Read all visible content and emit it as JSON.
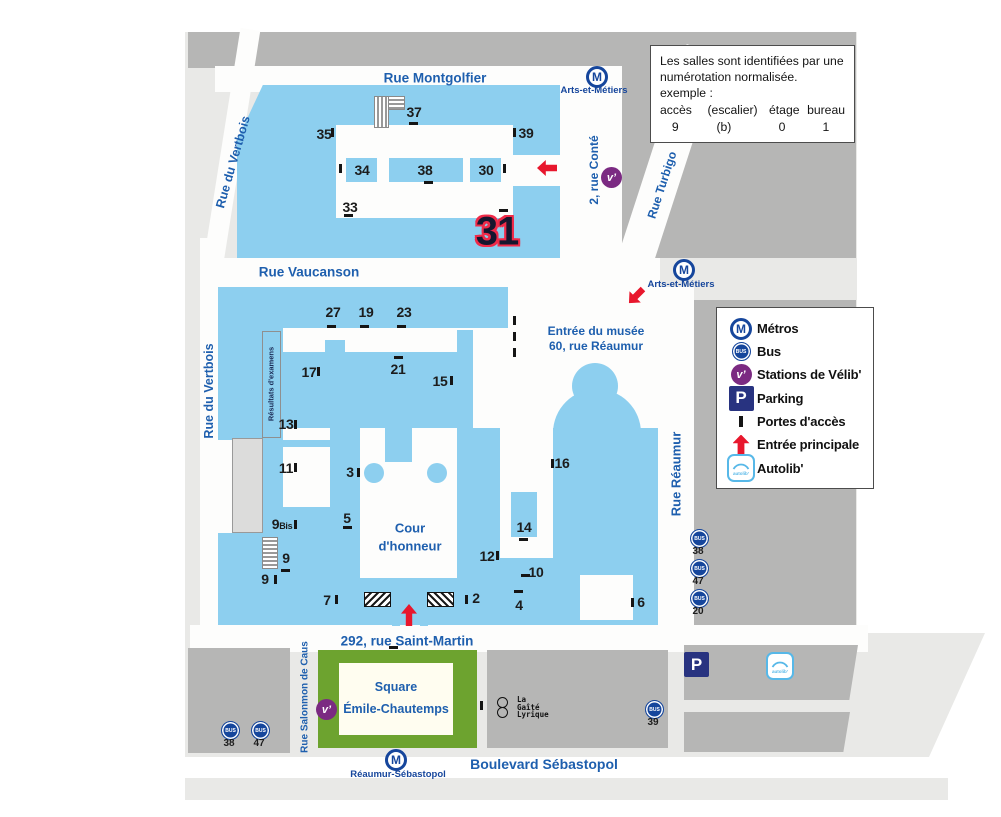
{
  "info_box": {
    "line1": "Les salles sont identifiées par une",
    "line2": "numérotation normalisée.",
    "line3": "exemple :",
    "col1": "accès",
    "col2": "(escalier)",
    "col3": "étage",
    "col4": "bureau",
    "val1": "9",
    "val2": "(b)",
    "val3": "0",
    "val4": "1"
  },
  "legend": {
    "metro": "Métros",
    "bus": "Bus",
    "velib": "Stations de Vélib'",
    "parking": "Parking",
    "doors": "Portes d'accès",
    "entrance": "Entrée principale",
    "autolib": "Autolib'"
  },
  "streets": {
    "montgolfier": "Rue Montgolfier",
    "vertbois": "Rue du Vertbois",
    "vaucanson": "Rue Vaucanson",
    "conte": "2, rue Conté",
    "turbigo": "Rue Turbigo",
    "reaumur": "Rue Réaumur",
    "saint_martin": "292, rue Saint-Martin",
    "salomon": "Rue Salonmon de Caus",
    "sebastopol": "Boulevard Sébastopol"
  },
  "metro_stations": {
    "arts_top": "Arts-et-Métiers",
    "arts_mid": "Arts-et-Métiers",
    "reaumur_seb": "Réaumur-Sébastopol"
  },
  "icons": {
    "metro_letter": "M",
    "bus_text": "BUS",
    "velib_text": "v’",
    "parking_letter": "P",
    "autolib_text": "autolib’"
  },
  "bus_stops": {
    "right": [
      "38",
      "47",
      "20"
    ],
    "left": [
      "38",
      "47"
    ],
    "gaite": "39"
  },
  "places": {
    "musee_line1": "Entrée du musée",
    "musee_line2": "60, rue Réaumur",
    "cour_line1": "Cour",
    "cour_line2": "d'honneur",
    "square_line1": "Square",
    "square_line2": "Émile-Chautemps",
    "gaite_line1": "La",
    "gaite_line2": "Gaîté",
    "gaite_line3": "Lyrique",
    "resultats": "Résultats d'examens"
  },
  "access": {
    "n37": "37",
    "n35": "35",
    "n39": "39",
    "n34": "34",
    "n38": "38",
    "n30": "30",
    "n33": "33",
    "n31": "31",
    "n27": "27",
    "n19": "19",
    "n23": "23",
    "n17": "17",
    "n21": "21",
    "n15": "15",
    "n13": "13",
    "n11": "11",
    "n3": "3",
    "n16": "16",
    "n5": "5",
    "n9bis": "9",
    "n9bis_suffix": "Bis",
    "n9a": "9",
    "n9b": "9",
    "n14": "14",
    "n12": "12",
    "n10": "10",
    "n7": "7",
    "n2": "2",
    "n4": "4",
    "n6": "6"
  },
  "colors": {
    "building_blue": "#8dcfef",
    "dark_gray": "#b6b6b5",
    "light_gray": "#e9e9e7",
    "street_label_blue": "#1e5fae",
    "metro_blue": "#16469c",
    "entrance_red": "#e8172d",
    "square_green": "#6da32f",
    "velib_purple": "#7b2a82",
    "parking_navy": "#283380",
    "autolib_blue": "#57b8e8",
    "big31_outline": "#ef2b49"
  }
}
